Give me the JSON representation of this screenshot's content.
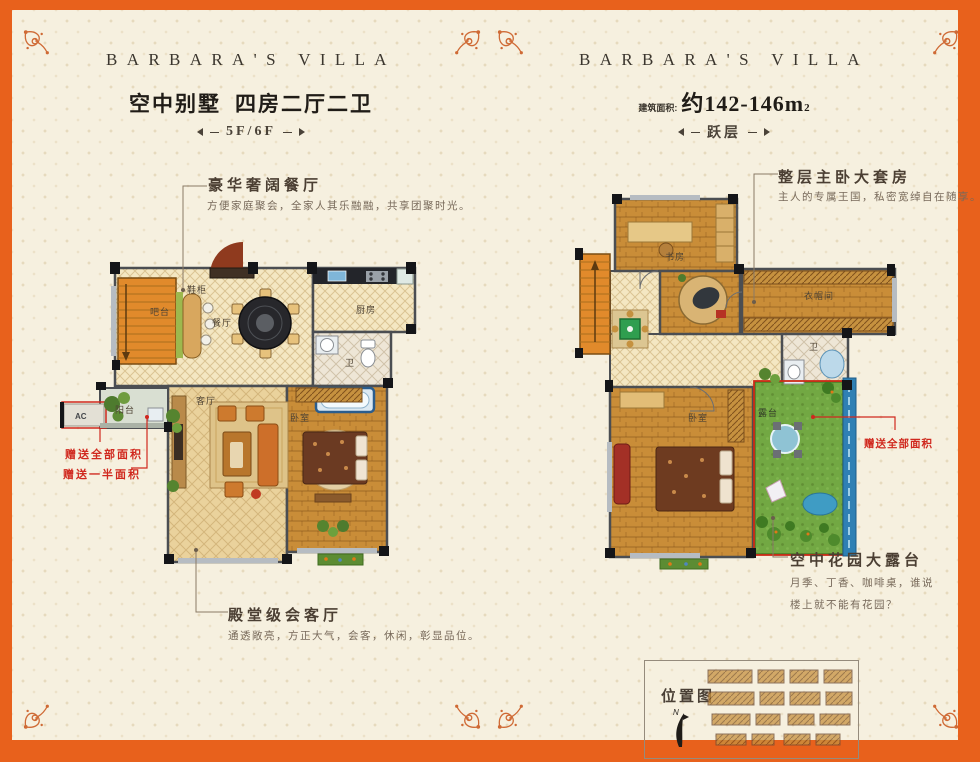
{
  "brand": "BARBARA'S VILLA",
  "left_header": {
    "title_main": "空中别墅",
    "title_sub": "四房二厅二卫",
    "floor_tag": "5F/6F"
  },
  "right_header": {
    "area_label": "建筑面积:",
    "area_value": "约142-146m",
    "area_sup": "2",
    "floor_tag": "跃层"
  },
  "left_callouts": {
    "dining_title": "豪华奢阔餐厅",
    "dining_desc": "方便家庭聚会，全家人其乐融融，共享团聚时光。",
    "living_title": "殿堂级会客厅",
    "living_desc": "通透敞亮，方正大气，会客，休闲，彰显品位。",
    "gift_full": "赠送全部面积",
    "gift_half": "赠送一半面积"
  },
  "right_callouts": {
    "master_title": "整层主卧大套房",
    "master_desc": "主人的专属王国，私密宽绰自在随享。",
    "terrace_title": "空中花园大露台",
    "terrace_desc1": "月季、丁香、咖啡桌，谁说",
    "terrace_desc2": "楼上就不能有花园？",
    "gift_full": "赠送全部面积"
  },
  "left_rooms": {
    "shoe": "鞋柜",
    "bar": "吧台",
    "dining": "餐厅",
    "kitchen": "厨房",
    "bath": "卫",
    "living": "客厅",
    "bedroom": "卧室",
    "balcony": "阳台",
    "ac": "AC"
  },
  "right_rooms": {
    "study": "书房",
    "cloakroom": "衣帽间",
    "bath": "卫",
    "bedroom": "卧室",
    "terrace": "露台"
  },
  "location": {
    "title": "位置图",
    "compass": "N"
  },
  "colors": {
    "frame": "#e8611c",
    "paper": "#f6f0df",
    "accent_red": "#d0281e",
    "ornament": "#cf6a35",
    "grass": "#72a843",
    "stair_orange": "#e18a2b"
  }
}
